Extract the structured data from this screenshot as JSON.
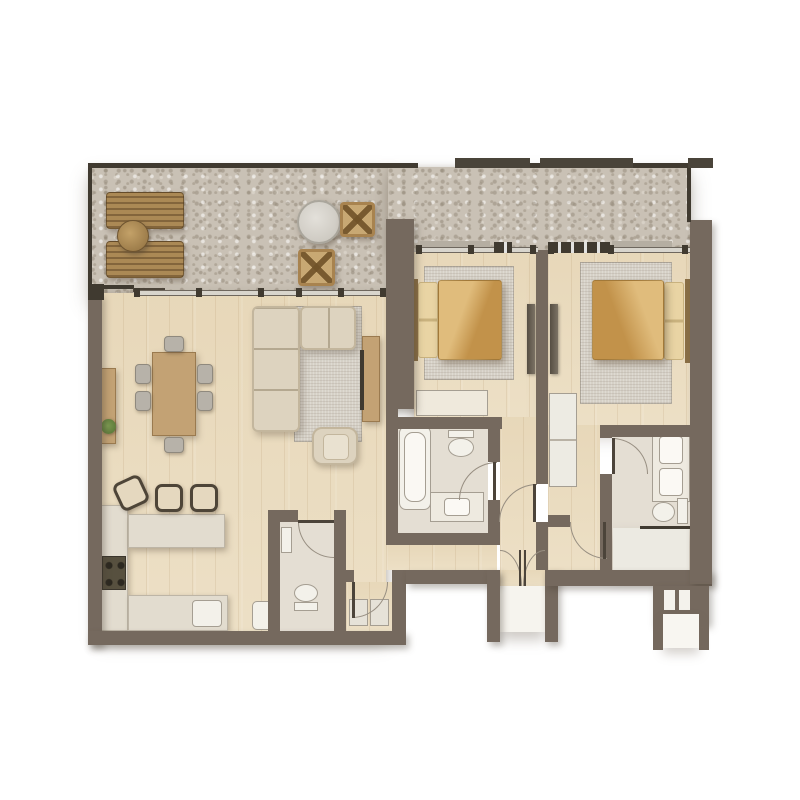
{
  "plan": {
    "kind": "apartment-floor-plan-render",
    "visible_text": [],
    "rooms": [
      {
        "name": "balcony",
        "floor": "stone",
        "furniture": [
          "sun-lounger",
          "sun-lounger",
          "round-side-table",
          "round-table",
          "wicker-chair",
          "wicker-chair"
        ]
      },
      {
        "name": "living-dining",
        "floor": "wood",
        "furniture": [
          "sectional-sofa",
          "area-rug",
          "armchair",
          "tv-console",
          "dining-table",
          "dining-chair-x6",
          "sideboard",
          "plant"
        ]
      },
      {
        "name": "kitchen",
        "floor": "wood",
        "furniture": [
          "l-counter",
          "cooktop",
          "sink",
          "peninsula-counter",
          "bar-stool-x3",
          "basin"
        ]
      },
      {
        "name": "bedroom-1",
        "floor": "wood",
        "furniture": [
          "double-bed",
          "area-rug",
          "dresser",
          "wardrobe"
        ]
      },
      {
        "name": "bedroom-2",
        "floor": "wood",
        "furniture": [
          "double-bed",
          "area-rug",
          "wardrobe",
          "built-in-closet"
        ]
      },
      {
        "name": "bathroom-1",
        "floor": "tile",
        "furniture": [
          "bathtub",
          "toilet",
          "vanity-sink"
        ]
      },
      {
        "name": "bathroom-2",
        "floor": "tile",
        "furniture": [
          "double-vanity",
          "toilet",
          "shower"
        ]
      },
      {
        "name": "wc",
        "floor": "tile",
        "furniture": [
          "toilet",
          "hand-basin"
        ]
      },
      {
        "name": "utility-closet",
        "floor": "wood",
        "furniture": [
          "washer",
          "dryer"
        ]
      },
      {
        "name": "entry-vestibule",
        "floor": "mat",
        "furniture": [
          "double-entry-door"
        ]
      },
      {
        "name": "utility-shaft",
        "floor": "none",
        "furniture": []
      }
    ]
  },
  "palette": {
    "background": "#ffffff",
    "wall": "#75695e",
    "wallDark": "#403a30",
    "floorWood": "#ebddc1",
    "stone": "#c9c1b5",
    "tile": "#e4ded3",
    "tileLight": "#eceae2",
    "rug": "#d6d1c7",
    "counter": "#e2dccf",
    "furnitureWood": "#c3a274",
    "loungerWood": "#ab8955",
    "sofa": "#ddd3bf",
    "bedDuvetLight": "#e0bc7c",
    "bedDuvetDark": "#c2924a",
    "pillow": "#e9d4a4",
    "fixtureWhite": "#f3f1ea",
    "fixtureLine": "#a59e92",
    "glass": "#d8d5cd",
    "arcLine": "#978e81",
    "plant": "#5f7d3c",
    "chair": "#b7b2a9",
    "stoolFrame": "#4e4538",
    "seat": "#e5d8bf"
  }
}
